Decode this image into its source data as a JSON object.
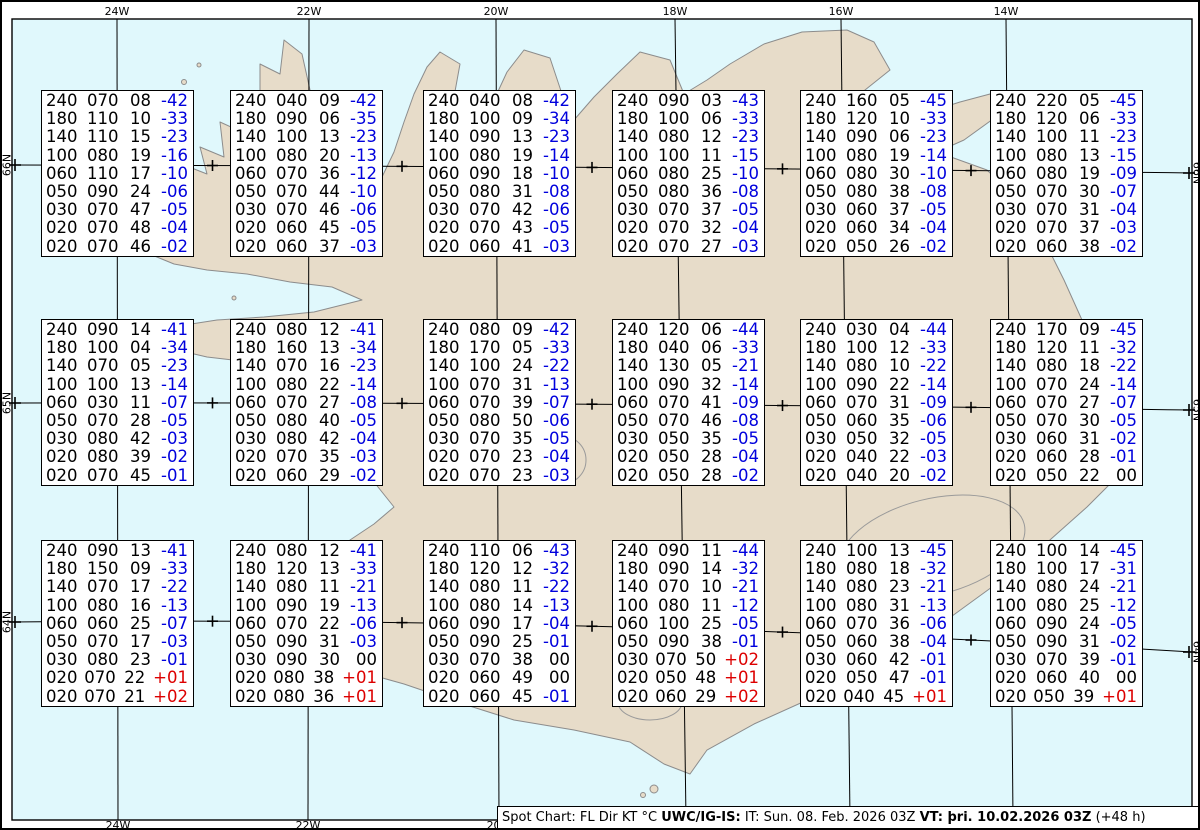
{
  "colors": {
    "sea": "#e0f8fc",
    "land": "#e7dcc9",
    "coast": "#8c8c8c",
    "glacier_outline": "#9a9a9a",
    "temp_neg": "#0000dd",
    "temp_pos": "#dd0000",
    "ink": "#000000"
  },
  "graticule": {
    "meridians": [
      {
        "label": "24W",
        "x_top": 115,
        "x_bottom": 116
      },
      {
        "label": "22W",
        "x_top": 307,
        "x_bottom": 306
      },
      {
        "label": "20W",
        "x_top": 494,
        "x_bottom": 497
      },
      {
        "label": "18W",
        "x_top": 673,
        "x_bottom": 684
      },
      {
        "label": "16W",
        "x_top": 839,
        "x_bottom": 848
      },
      {
        "label": "14W",
        "x_top": 1004,
        "x_bottom": 1011
      }
    ],
    "parallels": [
      {
        "label": "66N",
        "y_left": 163,
        "y_ctrl": 164,
        "y_right": 171
      },
      {
        "label": "65N",
        "y_left": 401,
        "y_ctrl": 400,
        "y_right": 408
      },
      {
        "label": "64N",
        "y_left": 620,
        "y_ctrl": 614,
        "y_right": 650
      }
    ],
    "cross_xs": [
      210.5,
      400,
      590,
      780.5,
      969
    ]
  },
  "status_bar": {
    "segments": [
      {
        "text": "Spot Chart: FL Dir KT °C ",
        "bold": false
      },
      {
        "text": "UWC/IG-IS:",
        "bold": true
      },
      {
        "text": " IT: Sun. 08. Feb. 2026 03Z ",
        "bold": false
      },
      {
        "text": "VT: þri. 10.02.2026 03Z",
        "bold": true
      },
      {
        "text": " (+48 h)",
        "bold": false
      }
    ]
  },
  "chart_data": {
    "type": "table",
    "title": "Spot Chart: FL Dir KT °C",
    "columns": [
      "FL",
      "Dir",
      "KT",
      "TempC"
    ],
    "issue_time": "Sun. 08. Feb. 2026 03Z",
    "valid_time": "þri. 10.02.2026 03Z (+48 h)",
    "stations": [
      {
        "row": 1,
        "col": 1,
        "values": [
          [
            "240",
            "070",
            "08",
            "-42"
          ],
          [
            "180",
            "110",
            "10",
            "-33"
          ],
          [
            "140",
            "110",
            "15",
            "-23"
          ],
          [
            "100",
            "080",
            "19",
            "-16"
          ],
          [
            "060",
            "110",
            "17",
            "-10"
          ],
          [
            "050",
            "090",
            "24",
            "-06"
          ],
          [
            "030",
            "070",
            "47",
            "-05"
          ],
          [
            "020",
            "070",
            "48",
            "-04"
          ],
          [
            "020",
            "070",
            "46",
            "-02"
          ]
        ]
      },
      {
        "row": 1,
        "col": 2,
        "values": [
          [
            "240",
            "040",
            "09",
            "-42"
          ],
          [
            "180",
            "090",
            "06",
            "-35"
          ],
          [
            "140",
            "100",
            "13",
            "-23"
          ],
          [
            "100",
            "080",
            "20",
            "-13"
          ],
          [
            "060",
            "070",
            "36",
            "-12"
          ],
          [
            "050",
            "070",
            "44",
            "-10"
          ],
          [
            "030",
            "070",
            "46",
            "-06"
          ],
          [
            "020",
            "060",
            "45",
            "-05"
          ],
          [
            "020",
            "060",
            "37",
            "-03"
          ]
        ]
      },
      {
        "row": 1,
        "col": 3,
        "values": [
          [
            "240",
            "040",
            "08",
            "-42"
          ],
          [
            "180",
            "100",
            "09",
            "-34"
          ],
          [
            "140",
            "090",
            "13",
            "-23"
          ],
          [
            "100",
            "080",
            "19",
            "-14"
          ],
          [
            "060",
            "090",
            "18",
            "-10"
          ],
          [
            "050",
            "080",
            "31",
            "-08"
          ],
          [
            "030",
            "070",
            "42",
            "-06"
          ],
          [
            "020",
            "070",
            "43",
            "-05"
          ],
          [
            "020",
            "060",
            "41",
            "-03"
          ]
        ]
      },
      {
        "row": 1,
        "col": 4,
        "values": [
          [
            "240",
            "090",
            "03",
            "-43"
          ],
          [
            "180",
            "100",
            "06",
            "-33"
          ],
          [
            "140",
            "080",
            "12",
            "-23"
          ],
          [
            "100",
            "100",
            "11",
            "-15"
          ],
          [
            "060",
            "080",
            "25",
            "-10"
          ],
          [
            "050",
            "080",
            "36",
            "-08"
          ],
          [
            "030",
            "070",
            "37",
            "-05"
          ],
          [
            "020",
            "070",
            "32",
            "-04"
          ],
          [
            "020",
            "070",
            "27",
            "-03"
          ]
        ]
      },
      {
        "row": 1,
        "col": 5,
        "values": [
          [
            "240",
            "160",
            "05",
            "-45"
          ],
          [
            "180",
            "120",
            "10",
            "-33"
          ],
          [
            "140",
            "090",
            "06",
            "-23"
          ],
          [
            "100",
            "080",
            "19",
            "-14"
          ],
          [
            "060",
            "080",
            "30",
            "-10"
          ],
          [
            "050",
            "080",
            "38",
            "-08"
          ],
          [
            "030",
            "060",
            "37",
            "-05"
          ],
          [
            "020",
            "060",
            "34",
            "-04"
          ],
          [
            "020",
            "050",
            "26",
            "-02"
          ]
        ]
      },
      {
        "row": 1,
        "col": 6,
        "values": [
          [
            "240",
            "220",
            "05",
            "-45"
          ],
          [
            "180",
            "120",
            "06",
            "-33"
          ],
          [
            "140",
            "100",
            "11",
            "-23"
          ],
          [
            "100",
            "080",
            "13",
            "-15"
          ],
          [
            "060",
            "080",
            "19",
            "-09"
          ],
          [
            "050",
            "070",
            "30",
            "-07"
          ],
          [
            "030",
            "070",
            "31",
            "-04"
          ],
          [
            "020",
            "070",
            "37",
            "-03"
          ],
          [
            "020",
            "060",
            "38",
            "-02"
          ]
        ]
      },
      {
        "row": 2,
        "col": 1,
        "values": [
          [
            "240",
            "090",
            "14",
            "-41"
          ],
          [
            "180",
            "100",
            "04",
            "-34"
          ],
          [
            "140",
            "070",
            "05",
            "-23"
          ],
          [
            "100",
            "100",
            "13",
            "-14"
          ],
          [
            "060",
            "030",
            "11",
            "-07"
          ],
          [
            "050",
            "070",
            "28",
            "-05"
          ],
          [
            "030",
            "080",
            "42",
            "-03"
          ],
          [
            "020",
            "080",
            "39",
            "-02"
          ],
          [
            "020",
            "070",
            "45",
            "-01"
          ]
        ]
      },
      {
        "row": 2,
        "col": 2,
        "values": [
          [
            "240",
            "080",
            "12",
            "-41"
          ],
          [
            "180",
            "160",
            "13",
            "-34"
          ],
          [
            "140",
            "070",
            "16",
            "-23"
          ],
          [
            "100",
            "080",
            "22",
            "-14"
          ],
          [
            "060",
            "070",
            "27",
            "-08"
          ],
          [
            "050",
            "080",
            "40",
            "-05"
          ],
          [
            "030",
            "080",
            "42",
            "-04"
          ],
          [
            "020",
            "070",
            "35",
            "-03"
          ],
          [
            "020",
            "060",
            "29",
            "-02"
          ]
        ]
      },
      {
        "row": 2,
        "col": 3,
        "values": [
          [
            "240",
            "080",
            "09",
            "-42"
          ],
          [
            "180",
            "170",
            "05",
            "-33"
          ],
          [
            "140",
            "100",
            "24",
            "-22"
          ],
          [
            "100",
            "070",
            "31",
            "-13"
          ],
          [
            "060",
            "070",
            "39",
            "-07"
          ],
          [
            "050",
            "080",
            "50",
            "-06"
          ],
          [
            "030",
            "070",
            "35",
            "-05"
          ],
          [
            "020",
            "070",
            "23",
            "-04"
          ],
          [
            "020",
            "070",
            "23",
            "-03"
          ]
        ]
      },
      {
        "row": 2,
        "col": 4,
        "values": [
          [
            "240",
            "120",
            "06",
            "-44"
          ],
          [
            "180",
            "040",
            "06",
            "-33"
          ],
          [
            "140",
            "130",
            "05",
            "-21"
          ],
          [
            "100",
            "090",
            "32",
            "-14"
          ],
          [
            "060",
            "070",
            "41",
            "-09"
          ],
          [
            "050",
            "070",
            "46",
            "-08"
          ],
          [
            "030",
            "050",
            "35",
            "-05"
          ],
          [
            "020",
            "050",
            "28",
            "-04"
          ],
          [
            "020",
            "050",
            "28",
            "-02"
          ]
        ]
      },
      {
        "row": 2,
        "col": 5,
        "values": [
          [
            "240",
            "030",
            "04",
            "-44"
          ],
          [
            "180",
            "100",
            "12",
            "-33"
          ],
          [
            "140",
            "080",
            "10",
            "-22"
          ],
          [
            "100",
            "090",
            "22",
            "-14"
          ],
          [
            "060",
            "070",
            "31",
            "-09"
          ],
          [
            "050",
            "060",
            "35",
            "-06"
          ],
          [
            "030",
            "050",
            "32",
            "-05"
          ],
          [
            "020",
            "040",
            "22",
            "-03"
          ],
          [
            "020",
            "040",
            "20",
            "-02"
          ]
        ]
      },
      {
        "row": 2,
        "col": 6,
        "values": [
          [
            "240",
            "170",
            "09",
            "-45"
          ],
          [
            "180",
            "120",
            "11",
            "-32"
          ],
          [
            "140",
            "080",
            "18",
            "-22"
          ],
          [
            "100",
            "070",
            "24",
            "-14"
          ],
          [
            "060",
            "070",
            "27",
            "-07"
          ],
          [
            "050",
            "070",
            "30",
            "-05"
          ],
          [
            "030",
            "060",
            "31",
            "-02"
          ],
          [
            "020",
            "060",
            "28",
            "-01"
          ],
          [
            "020",
            "050",
            "22",
            "00"
          ]
        ]
      },
      {
        "row": 3,
        "col": 1,
        "values": [
          [
            "240",
            "090",
            "13",
            "-41"
          ],
          [
            "180",
            "150",
            "09",
            "-33"
          ],
          [
            "140",
            "070",
            "17",
            "-22"
          ],
          [
            "100",
            "080",
            "16",
            "-13"
          ],
          [
            "060",
            "060",
            "25",
            "-07"
          ],
          [
            "050",
            "070",
            "17",
            "-03"
          ],
          [
            "030",
            "080",
            "23",
            "-01"
          ],
          [
            "020",
            "070",
            "22",
            "+01"
          ],
          [
            "020",
            "070",
            "21",
            "+02"
          ]
        ]
      },
      {
        "row": 3,
        "col": 2,
        "values": [
          [
            "240",
            "080",
            "12",
            "-41"
          ],
          [
            "180",
            "120",
            "13",
            "-33"
          ],
          [
            "140",
            "080",
            "11",
            "-21"
          ],
          [
            "100",
            "090",
            "19",
            "-13"
          ],
          [
            "060",
            "070",
            "22",
            "-06"
          ],
          [
            "050",
            "090",
            "31",
            "-03"
          ],
          [
            "030",
            "090",
            "30",
            "00"
          ],
          [
            "020",
            "080",
            "38",
            "+01"
          ],
          [
            "020",
            "080",
            "36",
            "+01"
          ]
        ]
      },
      {
        "row": 3,
        "col": 3,
        "values": [
          [
            "240",
            "110",
            "06",
            "-43"
          ],
          [
            "180",
            "120",
            "12",
            "-32"
          ],
          [
            "140",
            "080",
            "11",
            "-22"
          ],
          [
            "100",
            "080",
            "14",
            "-13"
          ],
          [
            "060",
            "090",
            "17",
            "-04"
          ],
          [
            "050",
            "090",
            "25",
            "-01"
          ],
          [
            "030",
            "070",
            "38",
            "00"
          ],
          [
            "020",
            "060",
            "49",
            "00"
          ],
          [
            "020",
            "060",
            "45",
            "-01"
          ]
        ]
      },
      {
        "row": 3,
        "col": 4,
        "values": [
          [
            "240",
            "090",
            "11",
            "-44"
          ],
          [
            "180",
            "090",
            "14",
            "-32"
          ],
          [
            "140",
            "070",
            "10",
            "-21"
          ],
          [
            "100",
            "080",
            "11",
            "-12"
          ],
          [
            "060",
            "100",
            "25",
            "-05"
          ],
          [
            "050",
            "090",
            "38",
            "-01"
          ],
          [
            "030",
            "070",
            "50",
            "+02"
          ],
          [
            "020",
            "050",
            "48",
            "+01"
          ],
          [
            "020",
            "060",
            "29",
            "+02"
          ]
        ]
      },
      {
        "row": 3,
        "col": 5,
        "values": [
          [
            "240",
            "100",
            "13",
            "-45"
          ],
          [
            "180",
            "080",
            "18",
            "-32"
          ],
          [
            "140",
            "080",
            "23",
            "-21"
          ],
          [
            "100",
            "080",
            "31",
            "-13"
          ],
          [
            "060",
            "070",
            "36",
            "-06"
          ],
          [
            "050",
            "060",
            "38",
            "-04"
          ],
          [
            "030",
            "060",
            "42",
            "-01"
          ],
          [
            "020",
            "050",
            "47",
            "-01"
          ],
          [
            "020",
            "040",
            "45",
            "+01"
          ]
        ]
      },
      {
        "row": 3,
        "col": 6,
        "values": [
          [
            "240",
            "100",
            "14",
            "-45"
          ],
          [
            "180",
            "100",
            "17",
            "-31"
          ],
          [
            "140",
            "080",
            "24",
            "-21"
          ],
          [
            "100",
            "080",
            "25",
            "-12"
          ],
          [
            "060",
            "090",
            "24",
            "-05"
          ],
          [
            "050",
            "090",
            "31",
            "-02"
          ],
          [
            "030",
            "070",
            "39",
            "-01"
          ],
          [
            "020",
            "060",
            "40",
            "00"
          ],
          [
            "020",
            "050",
            "39",
            "+01"
          ]
        ]
      }
    ]
  }
}
